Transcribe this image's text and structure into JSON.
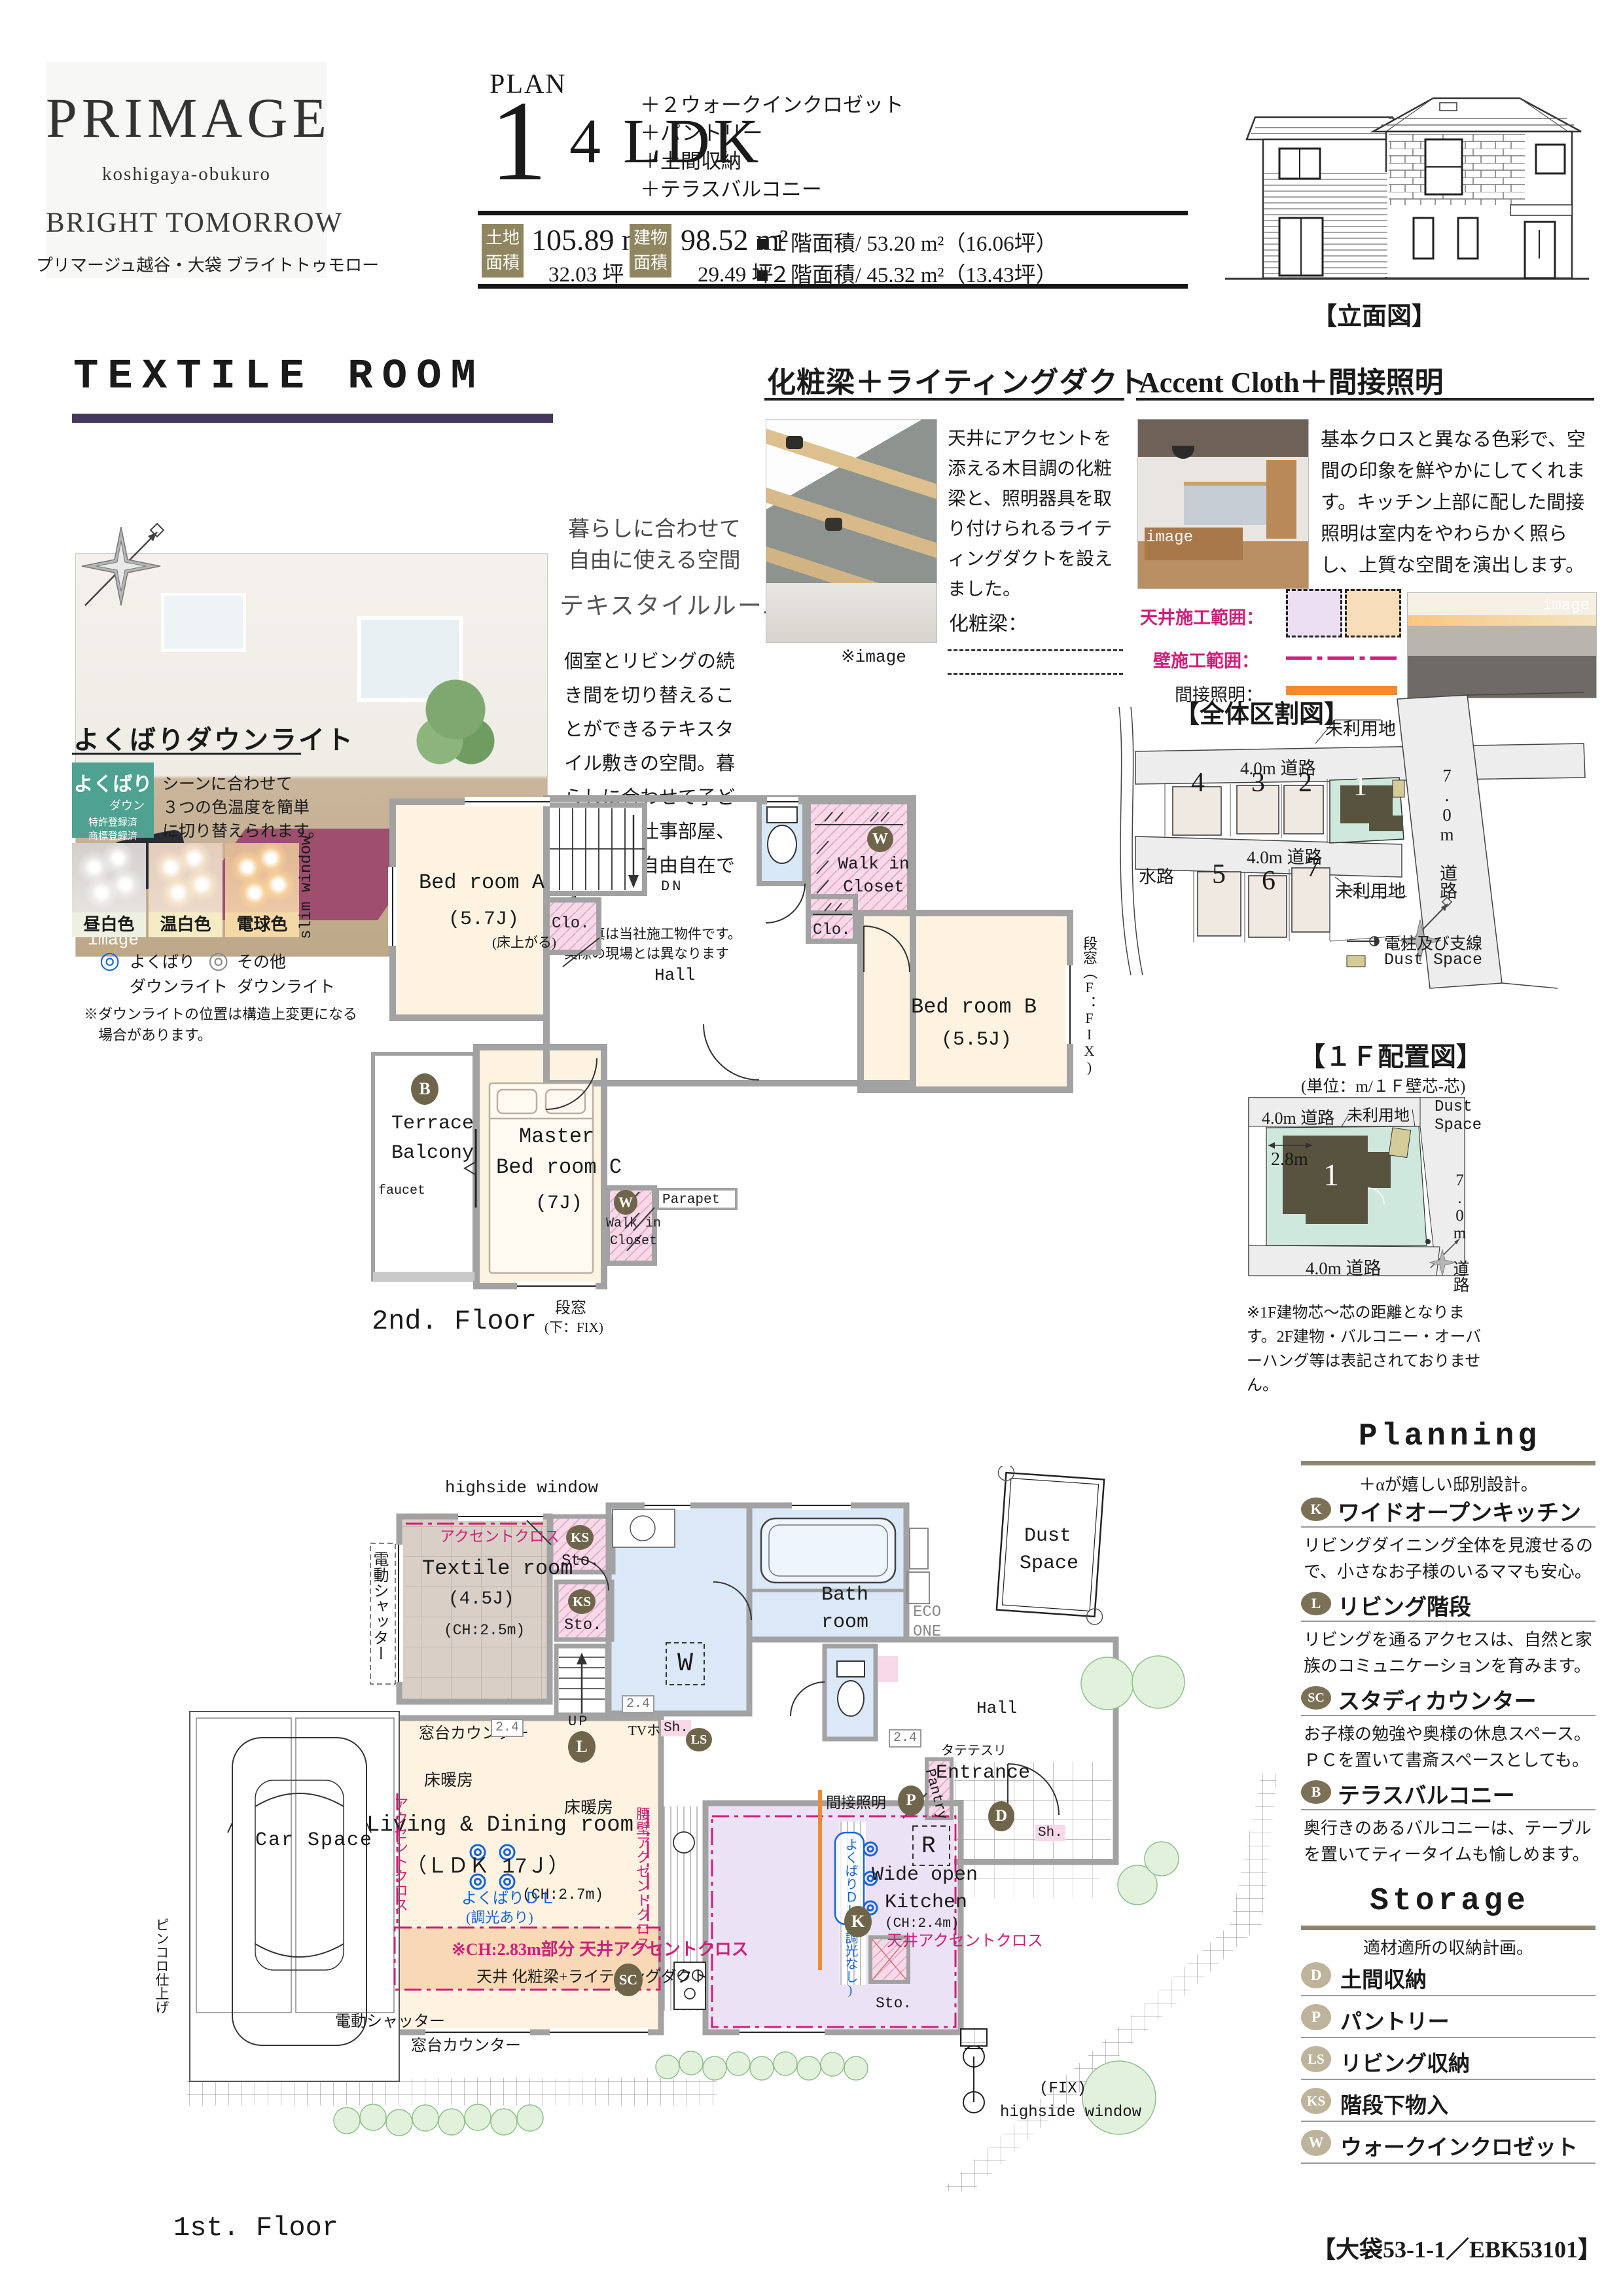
{
  "header": {
    "logo_name": "PRIMAGE",
    "logo_sub": "koshigaya-obukuro",
    "logo_tagline": "BRIGHT TOMORROW",
    "logo_tagline_jp": "プリマージュ越谷・大袋 ブライトトゥモロー",
    "plan_label": "PLAN",
    "plan_number": "1",
    "plan_type": "4 LDK",
    "features": [
      "＋２ウォークインクロゼット",
      "＋パントリー",
      "＋土間収納",
      "＋テラスバルコニー"
    ],
    "land_label1": "土地",
    "land_label2": "面積",
    "land_m2": "105.89 m²",
    "land_tsubo": "32.03 坪",
    "bldg_label1": "建物",
    "bldg_label2": "面積",
    "bldg_m2": "98.52 m²",
    "bldg_tsubo": "29.49 坪",
    "floor1_area": "■１階面積/ 53.20 m²（16.06坪）",
    "floor2_area": "■２階面積/ 45.32 m²（13.43坪）",
    "elevation_caption": "【立面図】"
  },
  "textile": {
    "title": "TEXTILE ROOM",
    "img": "image",
    "h1": "暮らしに合わせて自由に使える空間",
    "h2": "テキスタイルルーム",
    "body": "個室とリビングの続き間を切り替えることができるテキスタイル敷きの空間。暮らしに合わせて子ども部屋や仕事部屋、客間など自由自在です。",
    "note": "※写真は当社施工物件です。実際の現場とは異なります"
  },
  "beam": {
    "title": "化粧梁＋ライティングダクト",
    "body": "天井にアクセントを添える木目調の化粧梁と、照明器具を取り付けられるライティングダクトを設えました。",
    "legend": "化粧梁：",
    "img": "※image"
  },
  "accent": {
    "title": "Accent Cloth＋間接照明",
    "body": "基本クロスと異なる色彩で、空間の印象を鮮やかにしてくれます。キッチン上部に配した間接照明は室内をやわらかく照らし、上質な空間を演出します。",
    "l1": "天井施工範囲：",
    "l2": "壁施工範囲：",
    "l3": "間接照明：",
    "img": "image"
  },
  "downlight": {
    "title": "よくばりダウンライト",
    "badge1": "よくばり",
    "badge2": "ダウン",
    "badge3": "特許登録済",
    "badge4": "商標登録済",
    "body1": "シーンに合わせて",
    "body2": "３つの色温度を簡単",
    "body3": "に切り替えられます。",
    "modes": [
      "昼白色",
      "温白色",
      "電球色"
    ],
    "leg1a": "よくばり",
    "leg1b": "ダウンライト",
    "leg2a": "その他",
    "leg2b": "ダウンライト",
    "mark1": "◎",
    "mark2": "◎",
    "note1": "※ダウンライトの位置は構造上変更になる",
    "note2": "場合があります。"
  },
  "sitemap": {
    "title": "【全体区割図】",
    "road40a": "4.0m 道路",
    "road40b": "4.0m 道路",
    "road70": "7.0m 道路",
    "unused1": "未利用地",
    "unused2": "未利用地",
    "waterway": "水路",
    "lots": [
      "1",
      "2",
      "3",
      "4",
      "5",
      "6",
      "7"
    ],
    "legend_pole": "電柱及び支線",
    "legend_dust": "Dust Space"
  },
  "f2": {
    "caption": "2nd. Floor",
    "slim_window": "slim window",
    "bedA": "Bed room A",
    "bedA_size": "(5.7J)",
    "floor_up": "(床上がる)",
    "clo": "Clo.",
    "dn": "DN",
    "hall": "Hall",
    "w": "W",
    "wic1a": "Walk in",
    "wic1b": "Closet",
    "bedB": "Bed room B",
    "bedB_size": "(5.5J)",
    "win_right": "段窓（F：FIX)",
    "b": "B",
    "terrace1": "Terrace",
    "terrace2": "Balcony",
    "faucet": "faucet",
    "master1": "Master",
    "master2": "Bed room C",
    "master_size": "(7J)",
    "parapet": "Parapet",
    "win_b1": "段窓",
    "win_b2": "(下：FIX)"
  },
  "layout": {
    "title": "【１Ｆ配置図】",
    "subtitle": "(単位：m/１Ｆ壁芯-芯)",
    "road_top": "4.0m 道路",
    "road_bottom": "4.0m 道路",
    "road_right": "7.0m 道路",
    "unused": "未利用地",
    "dust1": "Dust",
    "dust2": "Space",
    "dim": "2.8m",
    "lot": "1",
    "note": "※1F建物芯～芯の距離となります。2F建物・バルコニー・オーバーハング等は表記されておりません。"
  },
  "f1": {
    "caption": "1st. Floor",
    "highside": "highside window",
    "shutter": "電動シャッター",
    "accent_cloth": "アクセントクロス",
    "textile": "Textile room",
    "textile_size": "(4.5J)",
    "textile_ch": "(CH:2.5m)",
    "ks": "KS",
    "sto": "Sto.",
    "up": "UP",
    "w_mark": "W",
    "bath1": "Bath",
    "bath2": "room",
    "eco1": "ECO",
    "eco2": "ONE",
    "dust1": "Dust",
    "dust2": "Space",
    "counter": "窓台カウンター",
    "d24": "2.4",
    "heat": "床暖房",
    "tv": "TVホン",
    "sh": "Sh.",
    "ls": "LS",
    "l": "L",
    "hall": "Hall",
    "tate": "タテテスリ",
    "entrance": "Entrance",
    "pantry": "Pantry",
    "p": "P",
    "d": "D",
    "ldk1": "Living & Dining room",
    "ldk2": "（ＬＤＫ 17Ｊ）",
    "ldk_ch": "(CH:2.7m)",
    "ydl1": "よくばりＤＬ",
    "ydl2": "(調光あり)",
    "koshikabe": "腰壁アクセントクロス",
    "ch283": "※CH:2.83m部分 天井アクセントクロス",
    "beam_duct": "天井 化粧梁+ライティングダクト",
    "sc": "SC",
    "indirect": "間接照明",
    "ydl_none": "よくばりＤＬ(調光なし)",
    "k": "K",
    "ceil_accent": "天井アクセントクロス",
    "kitchen1": "Wide open",
    "kitchen2": "Kitchen",
    "kitchen_ch": "(CH:2.4m)",
    "r": "R",
    "car": "Car Space",
    "pinkoro": "ピンコロ仕上げ",
    "fix": "(FIX)",
    "fix2": "highside window"
  },
  "planning": {
    "title": "Planning",
    "subtitle": "＋αが嬉しい邸別設計。",
    "items": [
      {
        "b": "K",
        "t": "ワイドオープンキッチン",
        "d": "リビングダイニング全体を見渡せるので、小さなお子様のいるママも安心。"
      },
      {
        "b": "L",
        "t": "リビング階段",
        "d": "リビングを通るアクセスは、自然と家族のコミュニケーションを育みます。"
      },
      {
        "b": "SC",
        "t": "スタディカウンター",
        "d": "お子様の勉強や奥様の休息スペース。ＰＣを置いて書斎スペースとしても。"
      },
      {
        "b": "B",
        "t": "テラスバルコニー",
        "d": "奥行きのあるバルコニーは、テーブルを置いてティータイムも愉しめます。"
      }
    ]
  },
  "storage": {
    "title": "Storage",
    "subtitle": "適材適所の収納計画。",
    "items": [
      {
        "b": "D",
        "t": "土間収納"
      },
      {
        "b": "P",
        "t": "パントリー"
      },
      {
        "b": "LS",
        "t": "リビング収納"
      },
      {
        "b": "KS",
        "t": "階段下物入"
      },
      {
        "b": "W",
        "t": "ウォークインクロゼット"
      }
    ]
  },
  "footer": {
    "code": "【大袋53-1-1／EBK53101】"
  }
}
